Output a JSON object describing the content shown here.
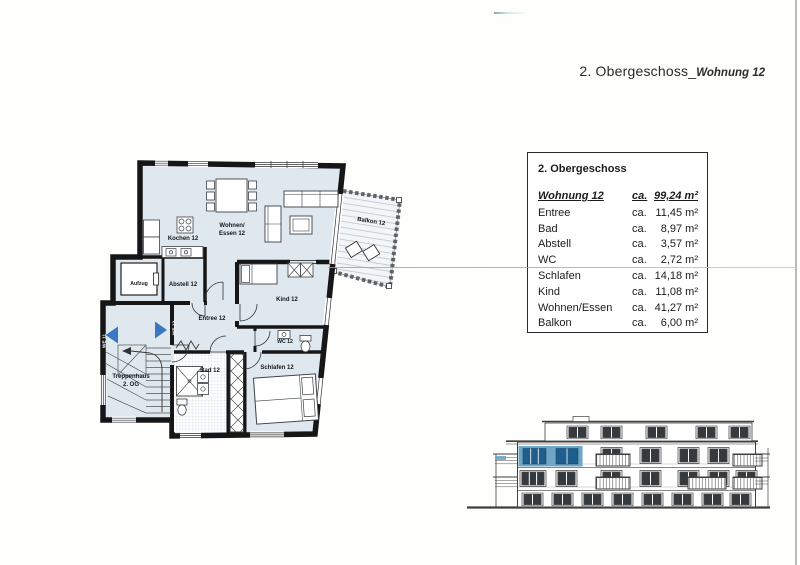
{
  "header": {
    "title_main": "2. Obergeschoss_",
    "title_sub": "Wohnung 12"
  },
  "area_table": {
    "title": "2. Obergeschoss",
    "total": {
      "label": "Wohnung 12",
      "ca": "ca.",
      "amount": "99,24 m²"
    },
    "rows": [
      {
        "label": "Entree",
        "ca": "ca.",
        "amount": "11,45 m²"
      },
      {
        "label": "Bad",
        "ca": "ca.",
        "amount": "8,97 m²"
      },
      {
        "label": "Abstell",
        "ca": "ca.",
        "amount": "3,57 m²"
      },
      {
        "label": "WC",
        "ca": "ca.",
        "amount": "2,72 m²"
      },
      {
        "label": "Schlafen",
        "ca": "ca.",
        "amount": "14,18 m²"
      },
      {
        "label": "Kind",
        "ca": "ca.",
        "amount": "11,08 m²"
      },
      {
        "label": "Wohnen/Essen",
        "ca": "ca.",
        "amount": "41,27 m²"
      },
      {
        "label": "Balkon",
        "ca": "ca.",
        "amount": "6,00 m²"
      }
    ]
  },
  "floor_plan": {
    "labels": {
      "kochen": "Kochen 12",
      "wohnen_1": "Wohnen/",
      "wohnen_2": "Essen 12",
      "balkon": "Balkon 12",
      "aufzug": "Aufzug",
      "abstell": "Abstell 12",
      "kind": "Kind 12",
      "entree": "Entree 12",
      "wc": "WC 12",
      "bad": "Bad 12",
      "schlafen": "Schlafen 12",
      "treppenhaus_1": "Treppenhaus",
      "treppenhaus_2": "2. OG",
      "we11": "WE 11",
      "we12": "WE 12"
    }
  },
  "colors": {
    "plan_fill": "#dfe8ee",
    "wall": "#161616",
    "elevation_highlight": "#6fa5c7",
    "highlight_window": "#1f5d8d",
    "arrow_blue": "#3a78c2",
    "scan_pink": "#e87d9e",
    "scan_teal": "#8fd8d2"
  }
}
